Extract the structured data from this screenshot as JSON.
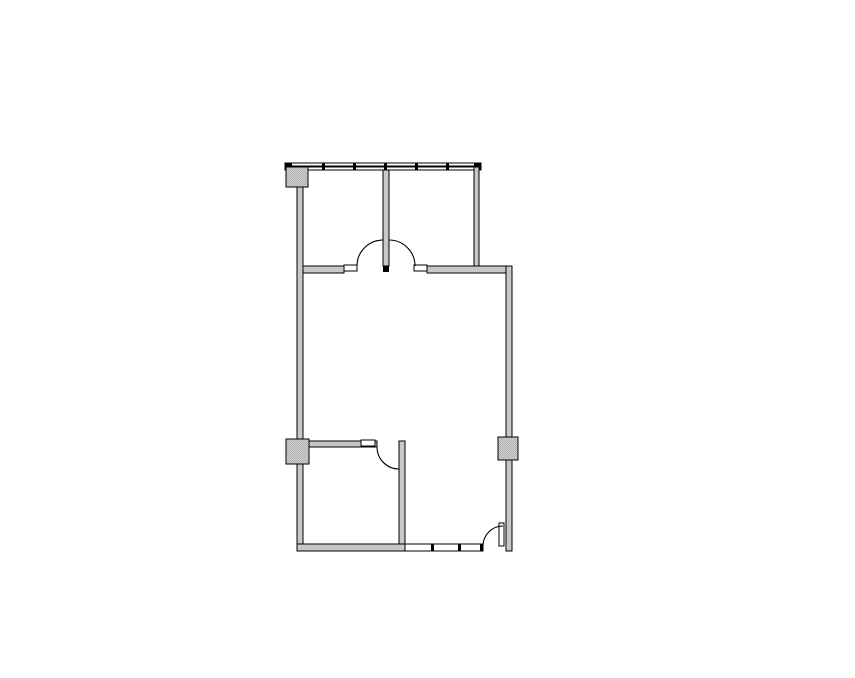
{
  "page": {
    "background": "#ffffff"
  },
  "floorplan": {
    "canvas": {
      "width": 855,
      "height": 678
    },
    "colors": {
      "line": "#000000",
      "wall_gray_light": "#d2d2d2",
      "wall_gray_dark": "#bdbdbd",
      "column_gray_light": "#cfcfcf",
      "column_gray_dark": "#b2b2b2",
      "white": "#ffffff",
      "black": "#000000"
    },
    "primitives": [
      {
        "type": "rect",
        "name": "window-wall-top-strip-upper",
        "x": 285,
        "y": 163,
        "w": 196,
        "h": 3,
        "fill": "white",
        "stroke": true
      },
      {
        "type": "rect",
        "name": "window-wall-top-strip-lower",
        "x": 285,
        "y": 167,
        "w": 196,
        "h": 3,
        "fill": "white",
        "stroke": true
      },
      {
        "type": "rect",
        "name": "window-wall-end-cap-left",
        "x": 285,
        "y": 163,
        "w": 7,
        "h": 7,
        "fill": "black",
        "stroke": false
      },
      {
        "type": "rect",
        "name": "window-wall-end-cap-right",
        "x": 474,
        "y": 163,
        "w": 7,
        "h": 7,
        "fill": "black",
        "stroke": false
      },
      {
        "type": "rect",
        "name": "window-mullion-mark-1",
        "x": 322,
        "y": 163,
        "w": 3,
        "h": 7,
        "fill": "black",
        "stroke": false
      },
      {
        "type": "rect",
        "name": "window-mullion-mark-2",
        "x": 353,
        "y": 163,
        "w": 3,
        "h": 7,
        "fill": "black",
        "stroke": false
      },
      {
        "type": "rect",
        "name": "window-mullion-mark-3",
        "x": 384,
        "y": 163,
        "w": 3,
        "h": 7,
        "fill": "black",
        "stroke": false
      },
      {
        "type": "rect",
        "name": "window-mullion-mark-4",
        "x": 415,
        "y": 163,
        "w": 3,
        "h": 7,
        "fill": "black",
        "stroke": false
      },
      {
        "type": "rect",
        "name": "window-mullion-mark-5",
        "x": 446,
        "y": 163,
        "w": 3,
        "h": 7,
        "fill": "black",
        "stroke": false
      },
      {
        "type": "rect",
        "name": "exterior-wall-left",
        "x": 297,
        "y": 170,
        "w": 6,
        "h": 381,
        "fill": "wall",
        "stroke": true
      },
      {
        "type": "rect",
        "name": "partition-wall-upper-rooms-divider",
        "x": 383,
        "y": 170,
        "w": 6,
        "h": 96,
        "fill": "wall",
        "stroke": true
      },
      {
        "type": "rect",
        "name": "partition-wall-divider-end-cap",
        "x": 383,
        "y": 266,
        "w": 6,
        "h": 6,
        "fill": "black",
        "stroke": false
      },
      {
        "type": "rect",
        "name": "wall-upper-rooms-right",
        "x": 474,
        "y": 167,
        "w": 5,
        "h": 99,
        "fill": "wall",
        "stroke": true
      },
      {
        "type": "rect",
        "name": "corridor-wall-left-segment",
        "x": 303,
        "y": 266,
        "w": 41,
        "h": 7,
        "fill": "wall",
        "stroke": true
      },
      {
        "type": "rect",
        "name": "corridor-wall-right-segment",
        "x": 427,
        "y": 266,
        "w": 85,
        "h": 7,
        "fill": "wall",
        "stroke": true
      },
      {
        "type": "rect",
        "name": "exterior-wall-right",
        "x": 506,
        "y": 266,
        "w": 6,
        "h": 285,
        "fill": "wall",
        "stroke": true
      },
      {
        "type": "rect",
        "name": "interior-wall-lower-room-top",
        "x": 309,
        "y": 441,
        "w": 68,
        "h": 6,
        "fill": "wall",
        "stroke": true
      },
      {
        "type": "rect",
        "name": "interior-wall-lower-room-right",
        "x": 399,
        "y": 441,
        "w": 6,
        "h": 110,
        "fill": "wall",
        "stroke": true
      },
      {
        "type": "rect",
        "name": "exterior-wall-bottom-left-segment",
        "x": 297,
        "y": 544,
        "w": 108,
        "h": 7,
        "fill": "wall",
        "stroke": true
      },
      {
        "type": "rect",
        "name": "low-wall-bottom-right-segment",
        "x": 405,
        "y": 544,
        "w": 78,
        "h": 7,
        "fill": "white",
        "stroke": true
      },
      {
        "type": "rect",
        "name": "low-wall-joint-mark-1",
        "x": 431,
        "y": 544,
        "w": 3,
        "h": 7,
        "fill": "black",
        "stroke": false
      },
      {
        "type": "rect",
        "name": "low-wall-joint-mark-2",
        "x": 458,
        "y": 544,
        "w": 3,
        "h": 7,
        "fill": "black",
        "stroke": false
      },
      {
        "type": "rect",
        "name": "low-wall-end-cap",
        "x": 480,
        "y": 544,
        "w": 3,
        "h": 7,
        "fill": "black",
        "stroke": false
      },
      {
        "type": "rect",
        "name": "column-top-left",
        "x": 286,
        "y": 167,
        "w": 22,
        "h": 20,
        "fill": "column",
        "stroke": true
      },
      {
        "type": "rect",
        "name": "column-mid-left",
        "x": 286,
        "y": 439,
        "w": 23,
        "h": 25,
        "fill": "column",
        "stroke": true
      },
      {
        "type": "rect",
        "name": "column-mid-right",
        "x": 498,
        "y": 437,
        "w": 20,
        "h": 23,
        "fill": "column",
        "stroke": true
      },
      {
        "type": "rect",
        "name": "door-leaf-upper-left-room",
        "x": 344,
        "y": 265,
        "w": 13,
        "h": 6,
        "fill": "white",
        "stroke": true
      },
      {
        "type": "rect",
        "name": "door-leaf-upper-right-room",
        "x": 414,
        "y": 265,
        "w": 13,
        "h": 6,
        "fill": "white",
        "stroke": true
      },
      {
        "type": "rect",
        "name": "door-leaf-lower-room",
        "x": 361,
        "y": 440,
        "w": 14,
        "h": 6,
        "fill": "white",
        "stroke": true
      },
      {
        "type": "rect",
        "name": "door-leaf-bottom-entry",
        "x": 499,
        "y": 523,
        "w": 5,
        "h": 23,
        "fill": "white",
        "stroke": true
      },
      {
        "type": "arc",
        "name": "door-swing-upper-left-room",
        "x1": 357,
        "y1": 266,
        "r": 26,
        "sweep": 1,
        "x2": 383,
        "y2": 240
      },
      {
        "type": "arc",
        "name": "door-swing-upper-right-room",
        "x1": 389,
        "y1": 240,
        "r": 26,
        "sweep": 1,
        "x2": 415,
        "y2": 266
      },
      {
        "type": "arc",
        "name": "door-swing-lower-room",
        "x1": 377,
        "y1": 447,
        "r": 22,
        "sweep": 0,
        "x2": 399,
        "y2": 469
      },
      {
        "type": "arc",
        "name": "door-swing-bottom-entry",
        "x1": 483,
        "y1": 546,
        "r": 20,
        "sweep": 1,
        "x2": 503,
        "y2": 526
      }
    ]
  }
}
